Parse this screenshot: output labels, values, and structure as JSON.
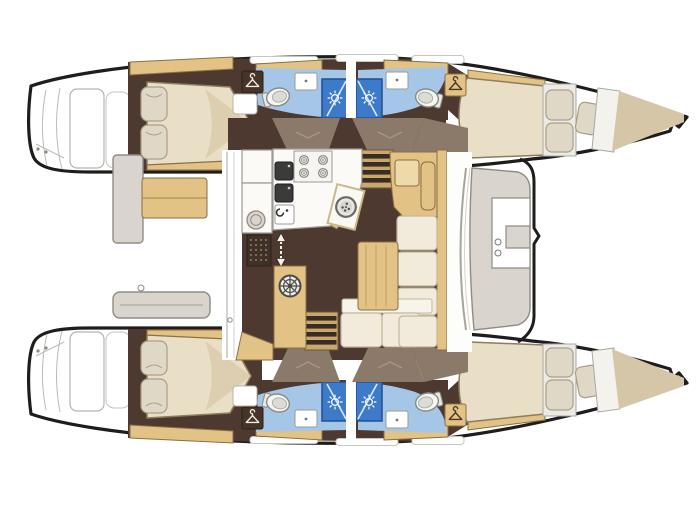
{
  "diagram": {
    "type": "floor-plan",
    "subject": "Catamaran sailing yacht accommodation and deck layout, bows to the right",
    "orientation": {
      "bow": "right",
      "stern": "left"
    },
    "hulls": [
      {
        "name": "port hull (top)",
        "rooms": [
          "aft double cabin with island bed and two pillows",
          "aft bathroom: toilet, vanity sink, shower cubicle",
          "forward bathroom: toilet, vanity sink, shower cubicle",
          "forward double cabin with bow berth and three pillows"
        ],
        "wardrobes": 2
      },
      {
        "name": "starboard hull (bottom)",
        "rooms": [
          "aft double cabin with island bed and two pillows",
          "aft bathroom: toilet, vanity sink, shower cubicle",
          "forward bathroom: toilet, vanity sink, shower cubicle",
          "forward double cabin with bow berth and three pillows"
        ],
        "wardrobes": 2
      }
    ],
    "salon": {
      "features": [
        "L-shaped galley counter",
        "four-burner stove",
        "double dark sink",
        "round sink module with drain dial",
        "fridge / floor grate",
        "companionway arrows up-down",
        "cabinet with round hatch wheel",
        "navigation desk",
        "L-shaped sofa",
        "wood coffee table",
        "steps down to each hull",
        "curved front windshield"
      ]
    },
    "cockpits": {
      "aft": [
        "bench seat (wood)",
        "side locker (gray)",
        "transverse bench (gray)",
        "swim platforms with steps on both sterns"
      ],
      "forward": [
        "C-shaped lounge seat",
        "foredeck / trampoline area boundary"
      ]
    },
    "counts": {
      "cabins": 4,
      "bathrooms": 4,
      "showers": 4,
      "toilets": 4,
      "wardrobe-lockers": 4,
      "stove-burners": 4
    }
  },
  "icons": {
    "sun": "shower-light-icon",
    "hanger": "wardrobe-hanger-icon",
    "wheel": "round-hatch-wheel-icon",
    "dial": "sink-drain-dial-icon",
    "toilet": "toilet-icon",
    "burner": "stove-burner-icon",
    "arrow_up": "companionway-up-arrow",
    "arrow_down": "companionway-down-arrow"
  },
  "palette": {
    "paper": "#ffffff",
    "outline": "#1e1d1b",
    "floor-dark": "#4d392f",
    "taupe": "#8b7a69",
    "wood": "#e2c285",
    "wood-edge": "#8a6f45",
    "wood-deep": "#caa76b",
    "bed-cream": "#e9dfc6",
    "bed-shade": "#d8c8a8",
    "bed-edge": "#8d7c5f",
    "pillow": "#e0d8c6",
    "pillow-edge": "#a99f88",
    "cushion": "#f2ebdb",
    "cushion-edge": "#c3b89d",
    "bath-blue": "#a5c6e7",
    "shower-blue": "#3d7bca",
    "shower-edge": "#215094",
    "furn-gray": "#d9d5ce",
    "furn-edge": "#908c85",
    "bow-beige": "#d6c6a8",
    "counter-edge": "#9a9a94",
    "appliance": "#3b3b3b",
    "line-gray": "#bdbbb5",
    "step-dark": "#3a2d24"
  }
}
